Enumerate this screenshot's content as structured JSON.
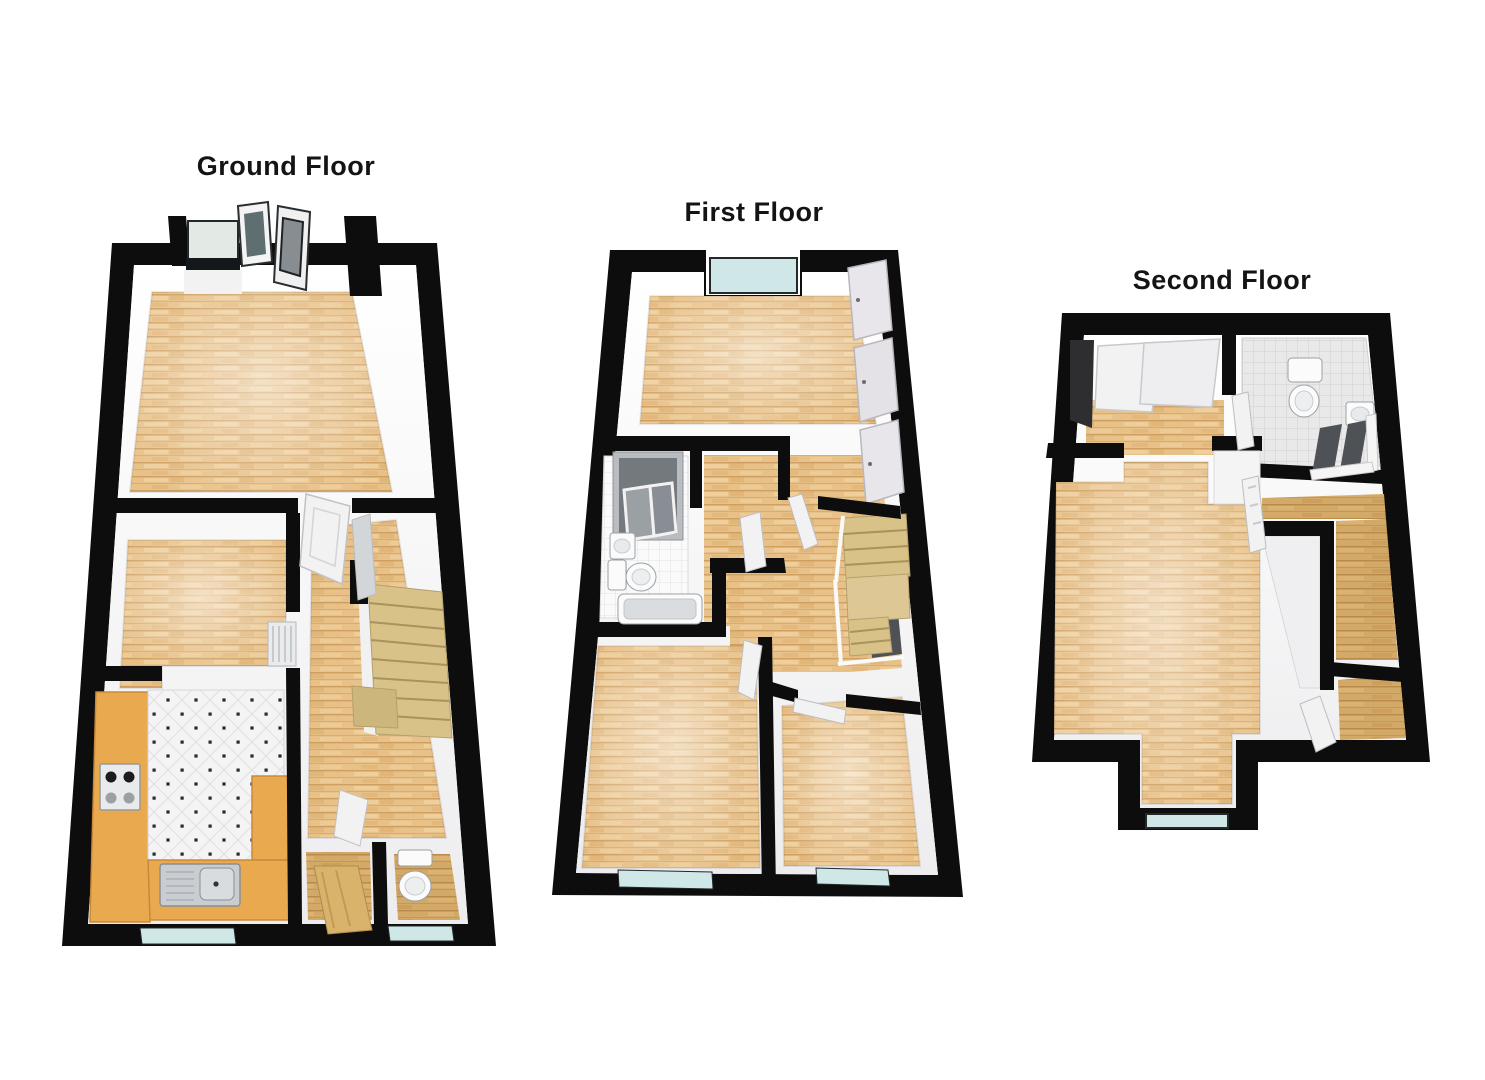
{
  "floors": [
    {
      "id": "ground-floor",
      "label": "Ground Floor"
    },
    {
      "id": "first-floor",
      "label": "First Floor"
    },
    {
      "id": "second-floor",
      "label": "Second Floor"
    }
  ],
  "fixtures": [
    "entrance-double-doors",
    "glazed-window",
    "staircase",
    "radiator",
    "door-leaf",
    "kitchen-worktop",
    "gas-hob",
    "kitchen-sink",
    "toilet",
    "wash-basin",
    "shower-cubicle",
    "bath",
    "wardrobe-panels",
    "dormer-window"
  ],
  "colors": {
    "background": "#ffffff",
    "label_text": "#141414",
    "wall": "#0d0d0d",
    "wall_face": "#f7f7f8",
    "wood": "#e8c189",
    "wood_line": "#c9995a",
    "wood_light": "#f3dbae",
    "wood_hall": "#d3a967",
    "glass": "#cfe8e7",
    "glass_pale": "#e3eae6",
    "door_glass": "#5e6e71",
    "door_panel": "#878d91",
    "tile_white": "#f4f4f4",
    "tile_grey": "#e9e9e9",
    "tile_line": "#c6c6c6",
    "counter": "#e9a94f",
    "stairs": "#d9c288",
    "stairs_line": "#a8925e",
    "fixture": "#fbfbfb",
    "fixture_shade": "#d9dde0",
    "steel": "#c9cdd1",
    "shower_dark": "#4e5256",
    "leaf": "#f2f2f3",
    "leaf_edge": "#bdbdc2"
  }
}
